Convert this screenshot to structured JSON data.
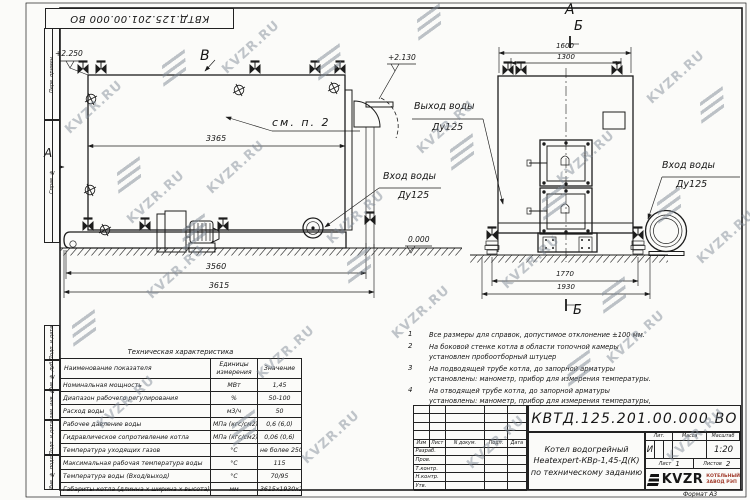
{
  "sheet": {
    "watermark_text": "KVZR.RU",
    "format_note": "Формат  А3"
  },
  "top_stamp": {
    "text": "КВТД.125.201.00.000  ВО"
  },
  "side_column": {
    "labels": [
      "Перв. примен.",
      "Справ. №",
      "Подп. и дата",
      "Инв. № дубл.",
      "Взам. инв. №",
      "Подп. и дата",
      "Инв. № подл."
    ]
  },
  "views": {
    "left": {
      "view_label": "В",
      "side_view_label": "А",
      "elev_top": "+2.250",
      "elev_right": "+2.130",
      "elev_zero": "0.000",
      "dim_body": "3365",
      "dim_frame": "3560",
      "dim_overall": "3615",
      "see_note": "см. п. 2",
      "inlet_title": "Вход воды",
      "inlet_dn": "Ду125"
    },
    "right": {
      "view_label": "А",
      "section_label_top": "Б",
      "section_label_bottom": "Б",
      "dim_top_outer": "1600",
      "dim_top_inner": "1300",
      "dim_bottom_inner": "1770",
      "dim_bottom_outer": "1930",
      "outlet_title": "Выход воды",
      "outlet_dn": "Ду125",
      "inlet_title": "Вход воды",
      "inlet_dn": "Ду125"
    }
  },
  "notes": {
    "items": [
      {
        "num": "1",
        "text": "Все размеры для справок, допустимое отклонение  ±100 мм."
      },
      {
        "num": "2",
        "text": "На боковой стенке котла в области топочной камеры установлен пробоотборный штуцер"
      },
      {
        "num": "3",
        "text": "На  подводящей трубе котла, до запорной арматуры установлены: манометр, прибор для измерения температуры."
      },
      {
        "num": "4",
        "text": "На отводящей трубе котла, до запорной арматуры установлены: манометр, прибор для измерения температуры, предохранительный клапан Ду не менее 50 мм и обвод с обратным клапаном Ду не менее 50 мм."
      }
    ]
  },
  "spec_table": {
    "title": "Техническая характеристика",
    "headers": [
      "Наименование показателя",
      "Единицы измерения",
      "Значение"
    ],
    "rows": [
      [
        "Номинальная мощность",
        "МВт",
        "1,45"
      ],
      [
        "Диапазон рабочего регулирования",
        "%",
        "50-100"
      ],
      [
        "Расход воды",
        "м3/ч",
        "50"
      ],
      [
        "Рабочее давление воды",
        "МПа (кгс/см2)",
        "0,6 (6,0)"
      ],
      [
        "Гидравлическое сопротивление котла",
        "МПа (кгс/см2)",
        "0,06 (0,6)"
      ],
      [
        "Температура уходящих газов",
        "°С",
        "не более 250"
      ],
      [
        "Максимальная рабочая температура воды",
        "°С",
        "115"
      ],
      [
        "Температура воды (Вход/выход)",
        "°С",
        "70/95"
      ],
      [
        "Габариты котла (длинна х ширина х высота)",
        "мм",
        "3615х1930х2250"
      ]
    ]
  },
  "title_block": {
    "designation": "КВТД.125.201.00.000  ВО",
    "name_line1": "Котел водогрейный",
    "name_line2": "Heatexpert-КВр-1,45-Д(К)",
    "name_line3": "по техническому заданию",
    "header_cols": [
      "Изм",
      "Лист",
      "N докум.",
      "Подп.",
      "Дата"
    ],
    "row_labels": [
      "Разраб.",
      "Пров.",
      "Т.контр.",
      "Н.контр.",
      "Утв."
    ],
    "lit_label": "Лит.",
    "lit_value": "И",
    "mass_label": "Масса",
    "scale_label": "Масштаб",
    "scale_value": "1:20",
    "sheet_label": "Лист",
    "sheet_value": "1",
    "sheets_label": "Листов",
    "sheets_value": "2",
    "logo_text": "KVZR",
    "company_line1": "КОТЕЛЬНЫЙ",
    "company_line2": "ЗАВОД РЭП"
  }
}
